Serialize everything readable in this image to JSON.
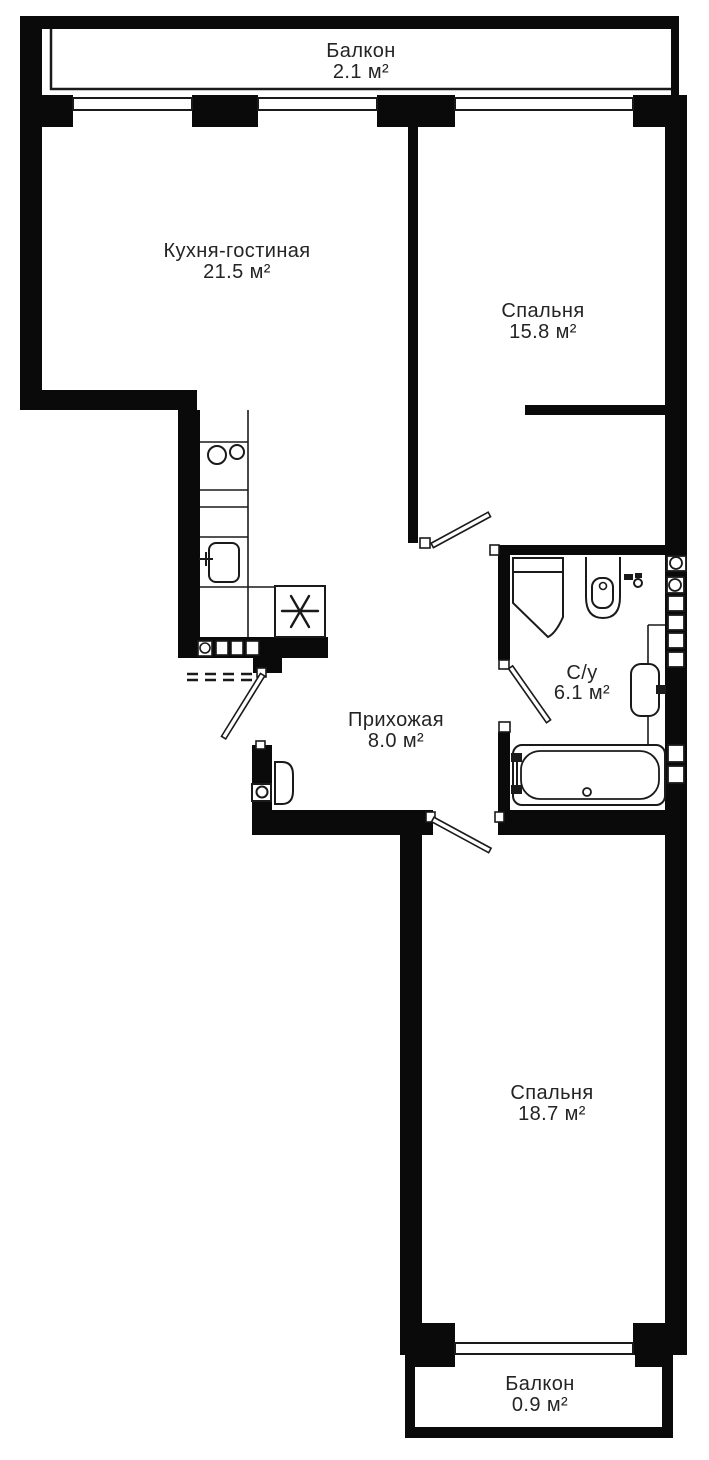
{
  "plan": {
    "title": "Floor plan",
    "unit_suffix": "м²",
    "rooms": [
      {
        "id": "balcony-top",
        "name": "Балкон",
        "area": "2.1 м²"
      },
      {
        "id": "kitchen-living",
        "name": "Кухня-гостиная",
        "area": "21.5 м²"
      },
      {
        "id": "bedroom-1",
        "name": "Спальня",
        "area": "15.8 м²"
      },
      {
        "id": "bathroom",
        "name": "С/у",
        "area": "6.1 м²"
      },
      {
        "id": "hallway",
        "name": "Прихожая",
        "area": "8.0 м²"
      },
      {
        "id": "bedroom-2",
        "name": "Спальня",
        "area": "18.7 м²"
      },
      {
        "id": "balcony-bottom",
        "name": "Балкон",
        "area": "0.9 м²"
      }
    ],
    "colors": {
      "wall": "#0a0a0a",
      "line": "#1a1a1a",
      "text": "#242424",
      "background": "#ffffff"
    }
  }
}
